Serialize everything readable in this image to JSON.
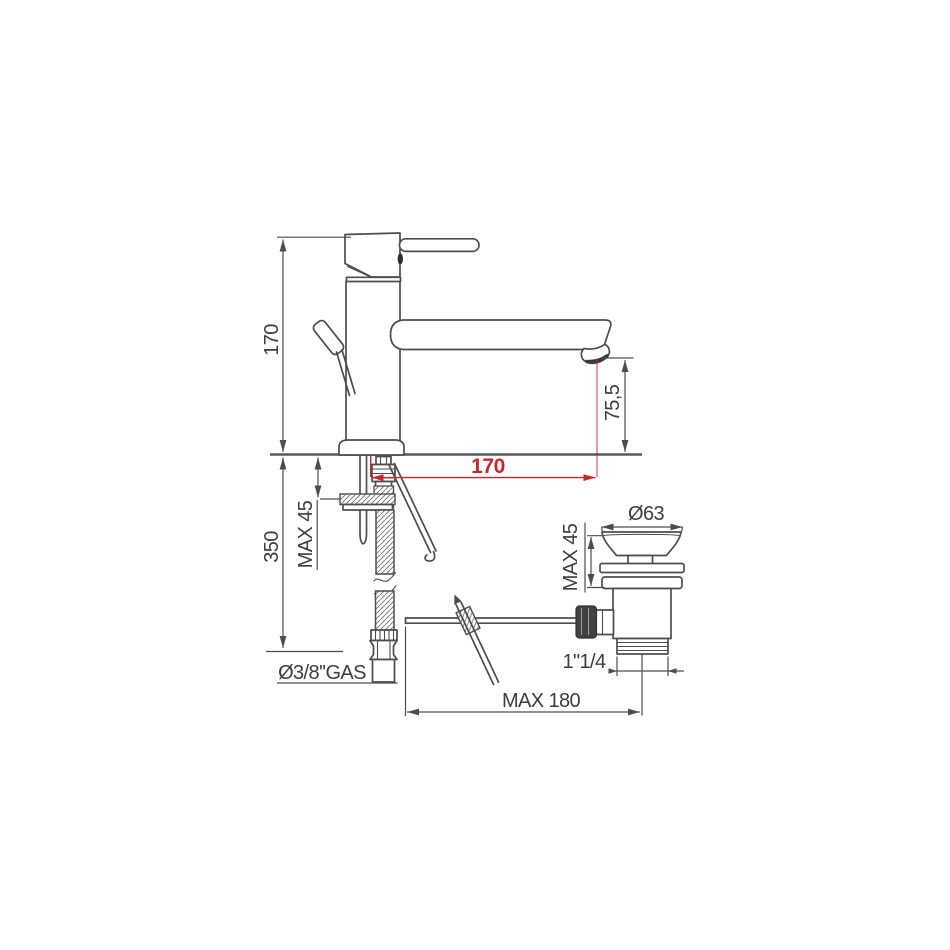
{
  "colors": {
    "background": "#ffffff",
    "line": "#4d4d4d",
    "text": "#3d3d3d",
    "dimension_red": "#c9252b"
  },
  "drawing": {
    "dimensions": {
      "faucet_height": "170",
      "spout_projection": "170",
      "spout_outlet_height": "75,5",
      "below_deck_depth": "350",
      "deck_max_thickness": "MAX 45",
      "supply_thread": "Ø3/8''GAS",
      "waste_cap_diameter": "Ø63",
      "basin_max_thickness": "MAX 45",
      "waste_thread": "1\"1/4",
      "linkage_rod_max": "MAX 180"
    }
  }
}
